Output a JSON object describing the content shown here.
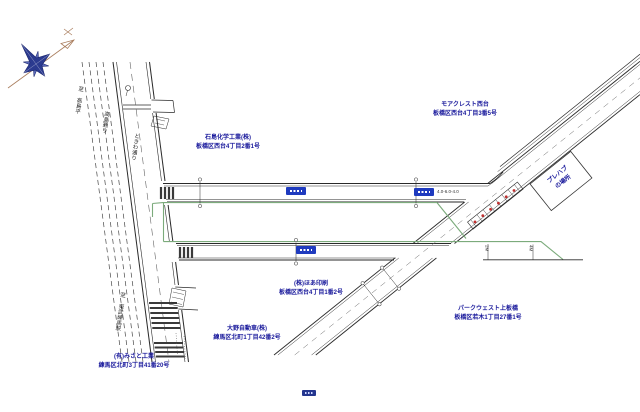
{
  "colors": {
    "line": "#2a2a2a",
    "work_zone_green": "#7cab7c",
    "label_navy": "#1a1a9c",
    "route_badge_blue": "#1f3bbf",
    "red_marker": "#c03030",
    "compass_navy": "#2b3a8f",
    "compass_arrow_tan": "#a97d5d"
  },
  "company_labels": [
    {
      "name": "ishijima-kagaku",
      "line1": "石島化学工業(株)",
      "line2": "板橋区西台4丁目2番1号"
    },
    {
      "name": "moa-crest-nishidai",
      "line1": "モアクレスト西台",
      "line2": "板橋区西台4丁目3番5号"
    },
    {
      "name": "hoa-insatsu",
      "line1": "(株)ほあ印刷",
      "line2": "板橋区西台4丁目1番2号"
    },
    {
      "name": "ohno-jidosha",
      "line1": "大野自動車(株)",
      "line2": "練馬区北町1丁目42番2号"
    },
    {
      "name": "misato-kogyo",
      "line1": "(有)みさと工業",
      "line2": "練馬区北町3丁目41番20号"
    },
    {
      "name": "park-west-kamiitabashi",
      "line1": "パークウェスト上板橋",
      "line2": "板橋区若木1丁目27番1号"
    }
  ],
  "prefab": {
    "line1": "プレハブ",
    "line2": "の場所"
  },
  "road_labels": [
    {
      "name": "to-takashimadaira",
      "text": "至 高島平"
    },
    {
      "name": "takashima-dori",
      "text": "高島通り"
    },
    {
      "name": "tokiwa-dori",
      "text": "ときわ通り"
    },
    {
      "name": "to-tobu-nerima-sta",
      "text": "至 東武練馬駅"
    }
  ],
  "annotations": [
    {
      "name": "road-width-note",
      "text": "4.0-6.0-4.0"
    },
    {
      "name": "dim-left",
      "text": "2M"
    },
    {
      "name": "dim-right",
      "text": "4M"
    }
  ]
}
